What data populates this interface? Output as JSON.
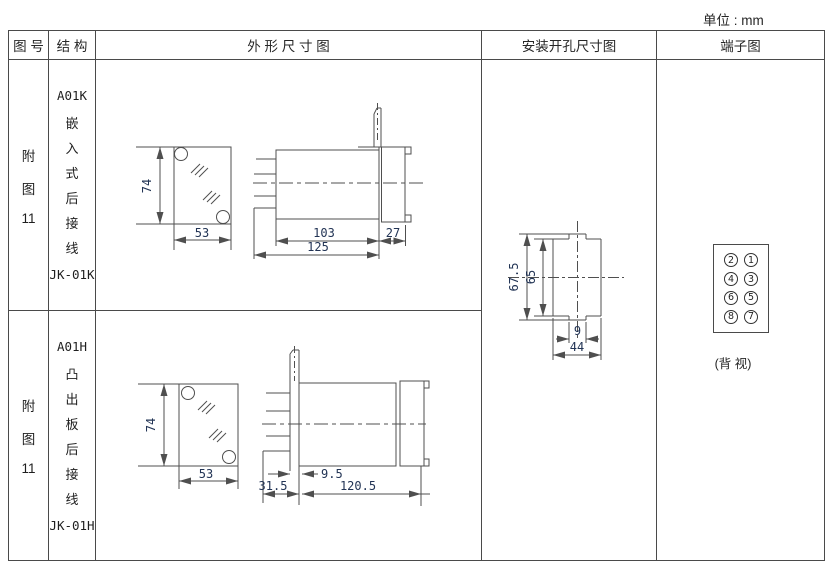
{
  "unit_label": "单位 : mm",
  "header": {
    "figure": "图 号",
    "structure": "结 构",
    "outline": "外 形 尺 寸 图",
    "mounting": "安装开孔尺寸图",
    "terminal": "端子图"
  },
  "rows": [
    {
      "figure": [
        "附",
        "图",
        "11"
      ],
      "model": "A01K",
      "structure": [
        "嵌",
        "入",
        "式",
        "后",
        "接",
        "线"
      ],
      "code": "JK-01K",
      "dims": {
        "height": "74",
        "width": "53",
        "body_depth": "103",
        "bezel_depth": "27",
        "total_depth": "125"
      }
    },
    {
      "figure": [
        "附",
        "图",
        "11"
      ],
      "model": "A01H",
      "structure": [
        "凸",
        "出",
        "板",
        "后",
        "接",
        "线"
      ],
      "code": "JK-01H",
      "dims": {
        "height": "74",
        "width": "53",
        "panel_gap": "9.5",
        "rear_depth": "31.5",
        "front_depth": "120.5"
      }
    }
  ],
  "mounting_hole": {
    "outer_height": "67.5",
    "hole_height": "65",
    "notch_width": "9",
    "hole_width": "44"
  },
  "terminal": {
    "numbers": [
      "2",
      "1",
      "4",
      "3",
      "6",
      "5",
      "8",
      "7"
    ],
    "caption": "(背 视)"
  }
}
